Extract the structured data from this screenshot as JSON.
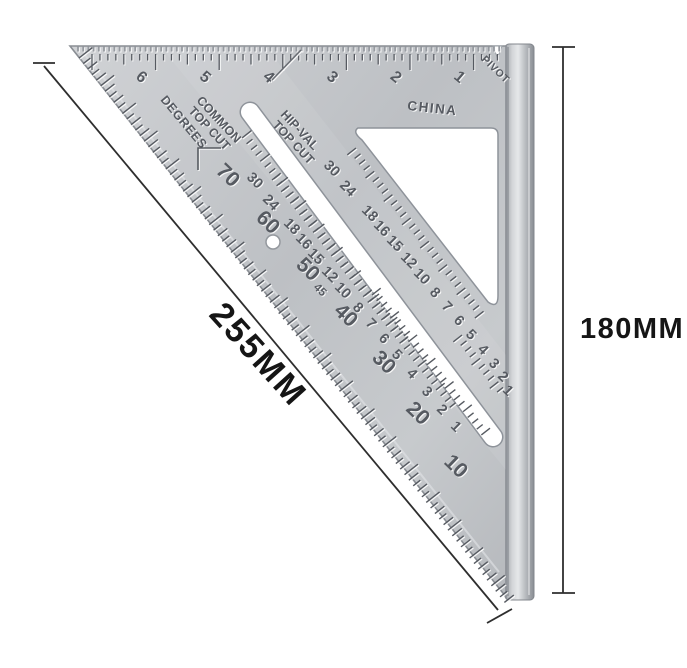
{
  "photo": {
    "object": "aluminum triangle speed square ruler on white background",
    "origin_text": "CHINA",
    "pivot_label": "PIVOT",
    "degrees_label": "DEGREES",
    "common_label": [
      "COMMON",
      "TOP CUT"
    ],
    "hipval_label": [
      "HIP-VAL",
      "TOP CUT"
    ],
    "scales": {
      "inch": [
        "6",
        "5",
        "4",
        "3",
        "2",
        "1"
      ],
      "degrees": [
        "70",
        "60",
        "50",
        "40",
        "30",
        "20",
        "10"
      ],
      "degrees_45": "45",
      "common": [
        "30",
        "24",
        "18",
        "16",
        "15",
        "12",
        "10"
      ],
      "common_cont": [
        "8",
        "7",
        "6",
        "5",
        "4",
        "3",
        "2",
        "1"
      ],
      "hipval": [
        "30",
        "24",
        "18",
        "16",
        "15",
        "12",
        "10",
        "8",
        "7",
        "6",
        "5",
        "4",
        "3",
        "2",
        "1"
      ]
    }
  },
  "annotations": {
    "hypotenuse_dimension": "255MM",
    "side_dimension": "180MM"
  },
  "colors": {
    "background": "#ffffff",
    "metal_light": "#d4d6d9",
    "metal_mid": "#bfc2c6",
    "metal_dark": "#8f939a",
    "engraving": "#565a61",
    "dimension_line": "#2e2e2e",
    "dimension_text": "#151515"
  }
}
